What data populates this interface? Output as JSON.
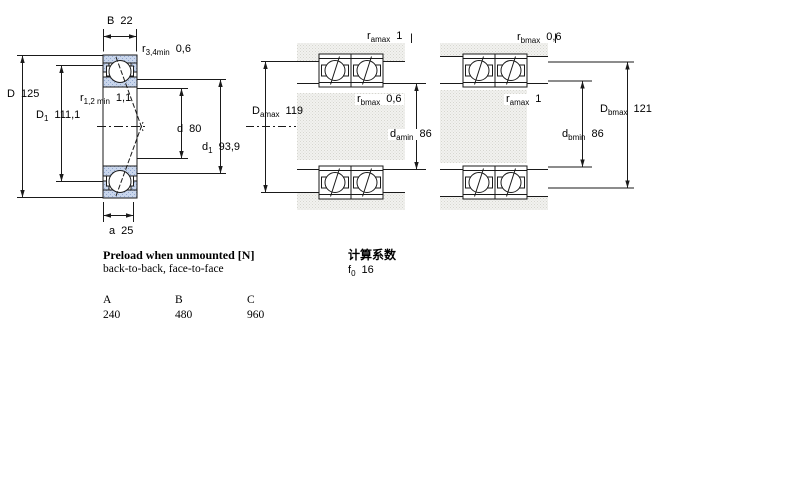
{
  "left_diagram": {
    "B": {
      "base": "B",
      "sub": "",
      "value": "22"
    },
    "r34": {
      "base": "r",
      "sub": "3,4min",
      "value": "0,6"
    },
    "D": {
      "base": "D",
      "sub": "",
      "value": "125"
    },
    "r12": {
      "base": "r",
      "sub": "1,2 min",
      "value": "1,1"
    },
    "D1": {
      "base": "D",
      "sub": "1",
      "value": "111,1"
    },
    "d": {
      "base": "d",
      "sub": "",
      "value": "80"
    },
    "d1": {
      "base": "d",
      "sub": "1",
      "value": "93,9"
    },
    "a": {
      "base": "a",
      "sub": "",
      "value": "25"
    }
  },
  "middle_diagram": {
    "r_amax": {
      "base": "r",
      "sub": "amax",
      "value": "1"
    },
    "D_amax": {
      "base": "D",
      "sub": "amax",
      "value": "119"
    },
    "r_bmax": {
      "base": "r",
      "sub": "bmax",
      "value": "0,6"
    },
    "d_amin": {
      "base": "d",
      "sub": "amin",
      "value": "86"
    }
  },
  "right_diagram": {
    "r_bmax": {
      "base": "r",
      "sub": "bmax",
      "value": "0,6"
    },
    "r_amax": {
      "base": "r",
      "sub": "amax",
      "value": "1"
    },
    "D_bmax": {
      "base": "D",
      "sub": "bmax",
      "value": "121"
    },
    "d_bmin": {
      "base": "d",
      "sub": "bmin",
      "value": "86"
    }
  },
  "preload": {
    "title": "Preload when unmounted [N]",
    "subtitle": "back-to-back, face-to-face",
    "columns": [
      "A",
      "B",
      "C"
    ],
    "values": [
      "240",
      "480",
      "960"
    ]
  },
  "calculation": {
    "title": "计算系数",
    "f0": {
      "base": "f",
      "sub": "0",
      "value": "16"
    }
  },
  "colors": {
    "line": "#1a1a1a",
    "ring_fill": "#c9d6ec",
    "ring_dot": "#92a8cf",
    "abutment_fill": "#f2f2ef",
    "abutment_dot": "#d6d6d0"
  }
}
